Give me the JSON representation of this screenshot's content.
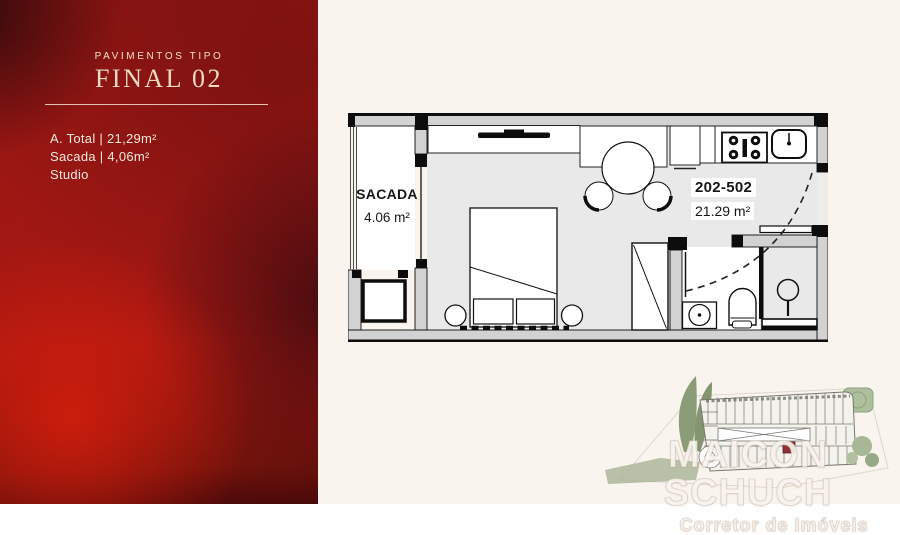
{
  "left_panel": {
    "eyebrow": "PAVIMENTOS TIPO",
    "title": "FINAL 02",
    "specs": [
      "A. Total | 21,29m²",
      "Sacada | 4,06m²",
      "Studio"
    ]
  },
  "floor_plan": {
    "balcony_label": "SACADA",
    "balcony_area": "4.06 m²",
    "unit_range": "202-502",
    "unit_area": "21.29 m²"
  },
  "watermark": {
    "name": "MAICON SCHUCH",
    "subtitle": "Corretor de Imóveis"
  },
  "colors": {
    "panel_red_bright": "#c01a0e",
    "panel_red_dark": "#4a0a0e",
    "background_cream": "#faf4ee",
    "wall_gray": "#d2d2d2",
    "floor_gray": "#e9e9e9",
    "keyplan_green": "#8b9c78",
    "unit_highlight_red": "#8e3136"
  }
}
